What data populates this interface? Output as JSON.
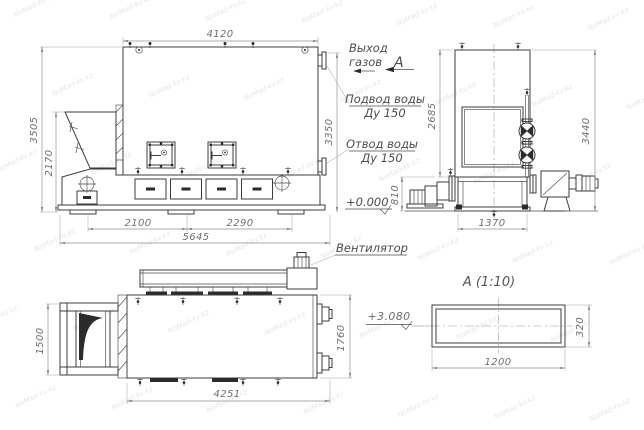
{
  "watermark": {
    "text": "NoMad-kv.kz"
  },
  "labels": {
    "gas_outlet_line1": "Выход",
    "gas_outlet_line2": "газов",
    "view_arrow": "А",
    "water_supply_line1": "Подвод воды",
    "water_supply_line2": "Ду 150",
    "water_return_line1": "Отвод воды",
    "water_return_line2": "Ду 150",
    "elevation_zero": "+0.000",
    "fan": "Вентилятор",
    "elevation_duct": "+3.080",
    "section_title": "А (1:10)"
  },
  "side_view": {
    "dim_top": "4120",
    "dim_height_total": "3505",
    "dim_height_hopper": "2170",
    "dim_height_right": "3350",
    "dim_bottom_left": "2100",
    "dim_bottom_right": "2290",
    "dim_bottom_total": "5645"
  },
  "end_view": {
    "dim_height_body": "2685",
    "dim_height_total": "3440",
    "dim_height_fan": "810",
    "dim_width_base": "1370"
  },
  "plan_view": {
    "dim_hopper_width": "1500",
    "dim_body_width": "1760",
    "dim_length": "4251"
  },
  "section_view": {
    "dim_width": "1200",
    "dim_height": "320"
  }
}
